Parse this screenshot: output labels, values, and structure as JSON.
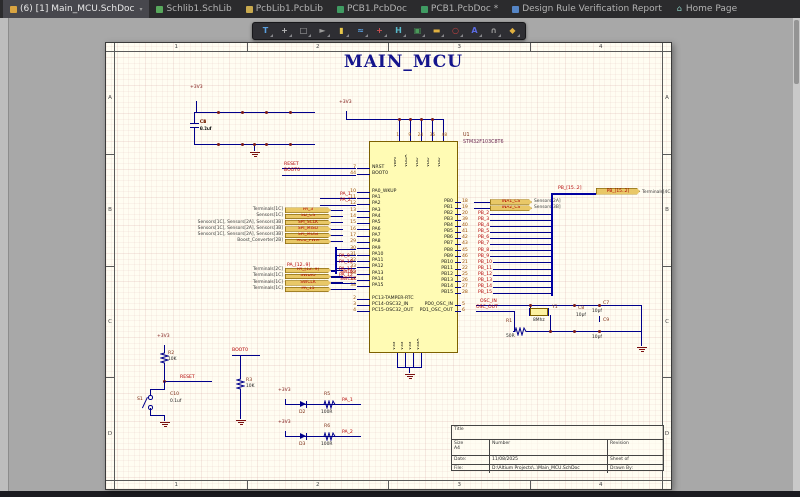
{
  "tabs": {
    "items": [
      {
        "label": "(6) [1] Main_MCU.SchDoc",
        "icon": "folder-icon",
        "bg": "#d9a441",
        "glyph": "",
        "fg": "",
        "active": true
      },
      {
        "label": "Schlib1.SchLib",
        "icon": "schlib-doc-icon",
        "bg": "#58a85c",
        "glyph": "",
        "fg": "",
        "active": false
      },
      {
        "label": "PcbLib1.PcbLib",
        "icon": "pcblib-doc-icon",
        "bg": "#c8a94e",
        "glyph": "",
        "fg": "",
        "active": false
      },
      {
        "label": "PCB1.PcbDoc",
        "icon": "pcb-doc-icon",
        "bg": "#3f9b62",
        "glyph": "",
        "fg": "",
        "active": false
      },
      {
        "label": "PCB1.PcbDoc *",
        "icon": "pcb-doc-icon",
        "bg": "#3f9b62",
        "glyph": "",
        "fg": "",
        "active": false
      },
      {
        "label": "Design Rule Verification Report",
        "icon": "report-doc-icon",
        "bg": "#5585c5",
        "glyph": "",
        "fg": "",
        "active": false
      },
      {
        "label": "Home Page",
        "icon": "home-icon",
        "bg": "",
        "glyph": "⌂",
        "fg": "#8fd4c8",
        "active": false
      }
    ]
  },
  "toolbar": {
    "icons": [
      {
        "name": "wiring-tool-icon",
        "glyph": "T",
        "color": "#5aa0e0"
      },
      {
        "name": "place-pin-icon",
        "glyph": "+",
        "color": "#b8b8b8"
      },
      {
        "name": "selection-icon",
        "glyph": "□",
        "color": "#b0b0b0"
      },
      {
        "name": "cursor-icon",
        "glyph": "►",
        "color": "#9a9a9a"
      },
      {
        "name": "place-part-icon",
        "glyph": "▮",
        "color": "#e8c84a"
      },
      {
        "name": "place-wire-icon",
        "glyph": "≈",
        "color": "#5aa0e0"
      },
      {
        "name": "place-junction-icon",
        "glyph": "+",
        "color": "#d05050"
      },
      {
        "name": "measure-icon",
        "glyph": "H",
        "color": "#58b8c8"
      },
      {
        "name": "sheet-symbol-icon",
        "glyph": "▣",
        "color": "#4a9a5a"
      },
      {
        "name": "port-icon",
        "glyph": "▬",
        "color": "#e0b040"
      },
      {
        "name": "no-erc-icon",
        "glyph": "○",
        "color": "#c04040"
      },
      {
        "name": "text-string-icon",
        "glyph": "A",
        "color": "#5a6ae0"
      },
      {
        "name": "arc-icon",
        "glyph": "∩",
        "color": "#9a9a9a"
      },
      {
        "name": "polygon-icon",
        "glyph": "◆",
        "color": "#e0b040"
      }
    ]
  },
  "sheet": {
    "title": "MAIN_MCU",
    "cols": [
      "1",
      "2",
      "3",
      "4"
    ],
    "rows": [
      "A",
      "B",
      "C",
      "D"
    ]
  },
  "decap": {
    "power": "+3V3",
    "caps": [
      {
        "ref": "C1",
        "value": "2.2uf"
      },
      {
        "ref": "C2",
        "value": "0.1uf"
      },
      {
        "ref": "C3",
        "value": "0.1uf"
      },
      {
        "ref": "C4",
        "value": "0.1uf"
      },
      {
        "ref": "C5",
        "value": "0.1uf"
      },
      {
        "ref": "C6",
        "value": "0.1uf"
      }
    ]
  },
  "mcu": {
    "designator": "U1",
    "part": "STM32F103C8T6",
    "power": "+3V3",
    "top_pin_nums": [
      "1",
      "9",
      "24",
      "36",
      "48"
    ],
    "top_pins": [
      {
        "name": "VBAT"
      },
      {
        "name": "VDDA"
      },
      {
        "name": "VDD"
      },
      {
        "name": "VDD"
      },
      {
        "name": "VDD"
      }
    ],
    "ctrl_pins": [
      {
        "name": "NRST",
        "num": "7"
      },
      {
        "name": "BOOT0",
        "num": "44"
      }
    ],
    "pa_pins": [
      {
        "name": "PA0_WKUP",
        "num": "10"
      },
      {
        "name": "PA1",
        "num": "11"
      },
      {
        "name": "PA2",
        "num": "12"
      },
      {
        "name": "PA3",
        "num": "13"
      },
      {
        "name": "PA4",
        "num": "14"
      },
      {
        "name": "PA5",
        "num": "15"
      },
      {
        "name": "PA6",
        "num": "16"
      },
      {
        "name": "PA7",
        "num": "17"
      },
      {
        "name": "PA8",
        "num": "29"
      },
      {
        "name": "PA9",
        "num": "30"
      },
      {
        "name": "PA10",
        "num": "31"
      },
      {
        "name": "PA11",
        "num": "32"
      },
      {
        "name": "PA12",
        "num": "33"
      },
      {
        "name": "PA13",
        "num": "34"
      },
      {
        "name": "PA14",
        "num": "37"
      },
      {
        "name": "PA15",
        "num": "38"
      }
    ],
    "pc_pins": [
      {
        "name": "PC13-TAMPER-RTC",
        "num": "2"
      },
      {
        "name": "PC14-OSC32_IN",
        "num": "3"
      },
      {
        "name": "PC15-OSC32_OUT",
        "num": "4"
      }
    ],
    "pb_pins": [
      {
        "name": "PB0",
        "num": "18"
      },
      {
        "name": "PB1",
        "num": "19"
      },
      {
        "name": "PB2",
        "num": "20"
      },
      {
        "name": "PB3",
        "num": "39"
      },
      {
        "name": "PB4",
        "num": "40"
      },
      {
        "name": "PB5",
        "num": "41"
      },
      {
        "name": "PB6",
        "num": "42"
      },
      {
        "name": "PB7",
        "num": "43"
      },
      {
        "name": "PB8",
        "num": "45"
      },
      {
        "name": "PB9",
        "num": "46"
      },
      {
        "name": "PB10",
        "num": "21"
      },
      {
        "name": "PB11",
        "num": "22"
      },
      {
        "name": "PB12",
        "num": "25"
      },
      {
        "name": "PB13",
        "num": "26"
      },
      {
        "name": "PB14",
        "num": "27"
      },
      {
        "name": "PB15",
        "num": "28"
      }
    ],
    "pd_pins": [
      {
        "name": "PD0_OSC_IN",
        "num": "5"
      },
      {
        "name": "PD1_OSC_OUT",
        "num": "6"
      }
    ],
    "bottom_pins": [
      {
        "name": "VSS"
      },
      {
        "name": "VSS"
      },
      {
        "name": "VSS"
      },
      {
        "name": "VSSA"
      }
    ]
  },
  "left_ports": [
    {
      "refs": "Terminals[1C]",
      "name": "PA_3"
    },
    {
      "refs": "Sensors[1C]",
      "name": "SD_CS"
    },
    {
      "refs": "Sensors[1C], Sensors[2A], Sensors[3B]",
      "name": "SPI_SCLK"
    },
    {
      "refs": "Sensors[1C], Sensors[2A], Sensors[3B]",
      "name": "SPI_MISO"
    },
    {
      "refs": "Sensors[1C], Sensors[2A], Sensors[3B]",
      "name": "SPI_MOSI"
    },
    {
      "refs": "Boost_Converter[2B]",
      "name": "MCU_PWM"
    }
  ],
  "left_ports2": [
    {
      "refs": "Terminals[2C]",
      "name": "PA_[12..9]"
    },
    {
      "refs": "Terminals[1C]",
      "name": "SWDIO"
    },
    {
      "refs": "Terminals[1C]",
      "name": "SWCLK"
    },
    {
      "refs": "Terminals[1C]",
      "name": "PA_15"
    }
  ],
  "left_nets": {
    "reset": "RESET",
    "boot0": "BOOT0",
    "pa1": "PA_1",
    "pa2": "PA_2",
    "bus_label": "PA_[12..9]",
    "bus_nets": [
      {
        "name": "PA_9"
      },
      {
        "name": "PA_10"
      },
      {
        "name": "PA_11"
      },
      {
        "name": "PA_12"
      }
    ],
    "swdio": "SWDIO",
    "swclk": "SWCLK"
  },
  "right_ports": [
    {
      "name": "INA1_CS",
      "refs": "Sensors[2A]"
    },
    {
      "name": "INA2_CS",
      "refs": "Sensors[3B]"
    }
  ],
  "right_bus": {
    "label": "PB_[15..2]",
    "port": "PB_[15..2]",
    "refs": "Terminals[4C]",
    "nets": [
      {
        "name": "PB_2"
      },
      {
        "name": "PB_3"
      },
      {
        "name": "PB_4"
      },
      {
        "name": "PB_5"
      },
      {
        "name": "PB_6"
      },
      {
        "name": "PB_7"
      },
      {
        "name": "PB_8"
      },
      {
        "name": "PB_9"
      },
      {
        "name": "PB_10"
      },
      {
        "name": "PB_11"
      },
      {
        "name": "PB_12"
      },
      {
        "name": "PB_13"
      },
      {
        "name": "PB_14"
      },
      {
        "name": "PB_15"
      }
    ]
  },
  "osc": {
    "in": "OSC_IN",
    "out": "OSC_OUT",
    "y1": {
      "ref": "Y1",
      "value": "8Mhz"
    },
    "r1": {
      "ref": "R1",
      "value": "50R"
    },
    "c7": {
      "ref": "C7",
      "value": "10pf"
    },
    "c8": {
      "ref": "C8",
      "value": "10pf"
    },
    "c9": {
      "ref": "C9",
      "value": "10pf"
    }
  },
  "reset": {
    "power": "+3V3",
    "r2": {
      "ref": "R2",
      "value": "10K"
    },
    "net": "RESET",
    "s1": "S1",
    "c10": {
      "ref": "C10",
      "value": "0.1uf"
    }
  },
  "boot": {
    "net": "BOOT0",
    "r3": {
      "ref": "R3",
      "value": "10K"
    }
  },
  "leds": [
    {
      "power": "+3V3",
      "diode": "D2",
      "res": "R5",
      "res_value": "100R",
      "net": "PA_1"
    },
    {
      "power": "+3V3",
      "diode": "D3",
      "res": "R6",
      "res_value": "100R",
      "net": "PA_2"
    }
  ],
  "titleblock": {
    "title_label": "Title",
    "size_label": "Size",
    "size": "A4",
    "number_label": "Number",
    "revision_label": "Revision",
    "date_label": "Date:",
    "date": "11/08/2025",
    "sheet_label": "Sheet  of",
    "file_label": "File:",
    "file": "D:\\Altium Projects\\..\\Main_MCU.SchDoc",
    "drawn_label": "Drawn By:"
  }
}
